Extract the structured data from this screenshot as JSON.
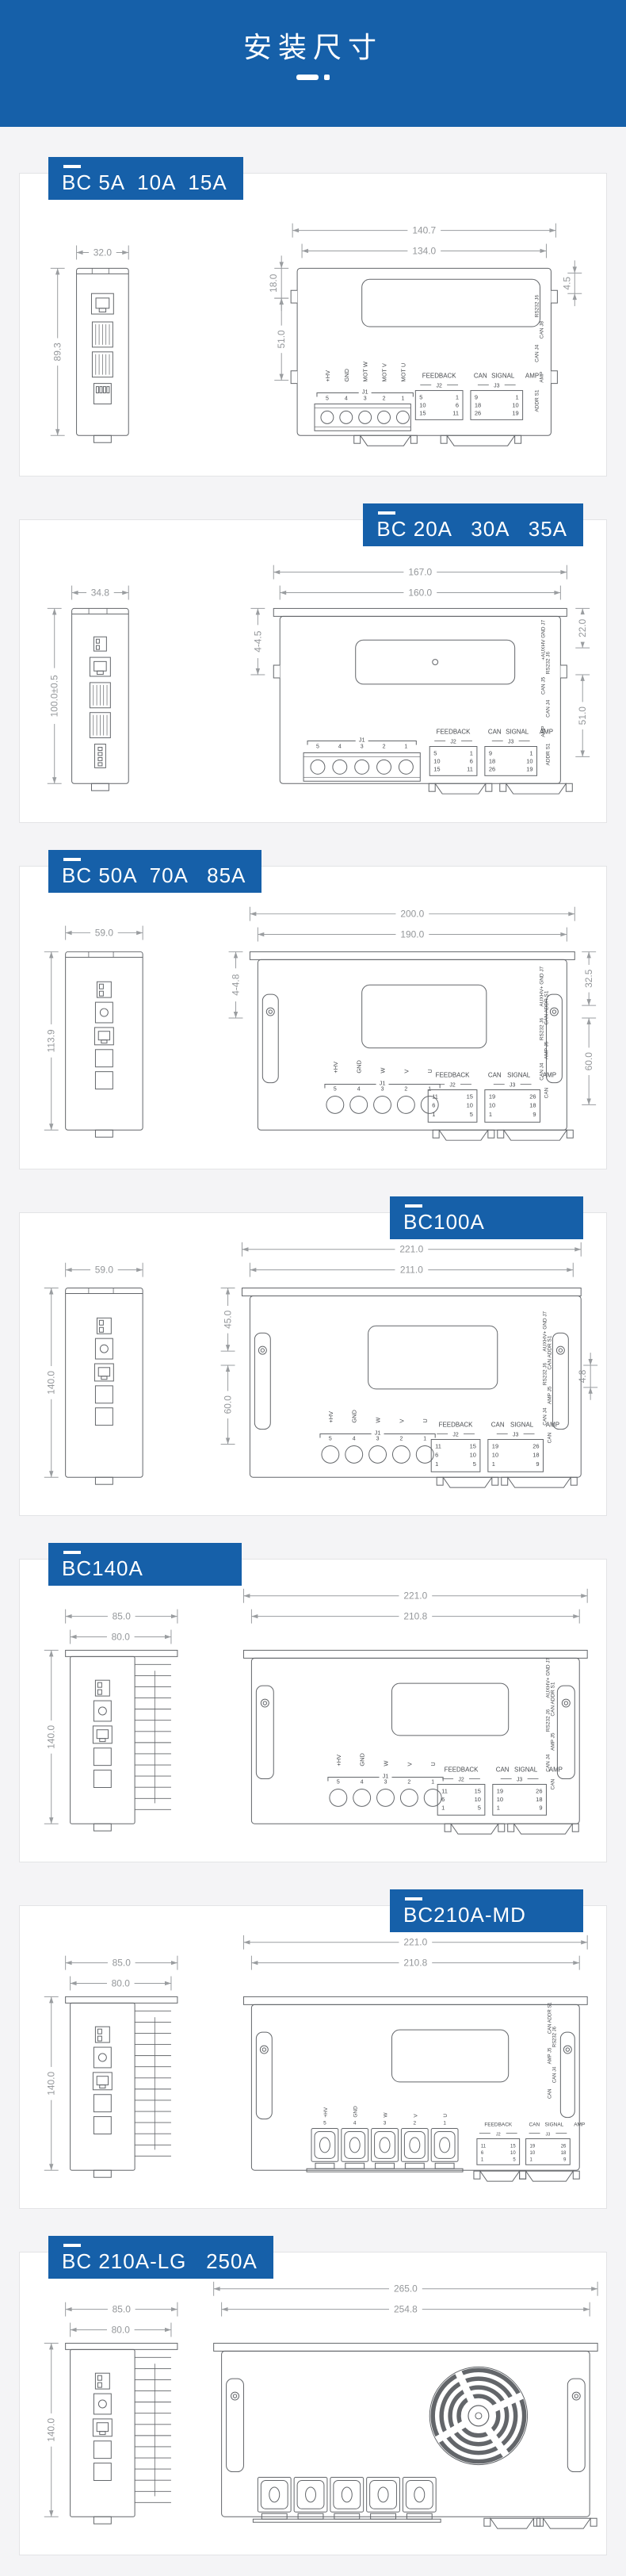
{
  "header": {
    "title": "安装尺寸"
  },
  "colors": {
    "accent": "#1660a9",
    "page_bg": "#f4f4f6",
    "card_bg": "#ffffff",
    "line": "#63666a",
    "dim_line": "#9a9da0"
  },
  "common": {
    "feedback": "FEEDBACK",
    "signal": "SIGNAL",
    "can": "CAN",
    "amp": "AMP",
    "j1": "J1",
    "j2": "J2",
    "j3": "J3"
  },
  "sections": [
    {
      "label": "BC 5A  10A  15A",
      "dims": {
        "side_w": "32.0",
        "side_h": "89.3",
        "front_w1": "140.7",
        "front_w2": "134.0",
        "left_a": "18.0",
        "left_b": "51.0",
        "right_a": "4.5"
      },
      "terminal_names": [
        "+HV",
        "GND",
        "MOT W",
        "MOT V",
        "MOT U"
      ],
      "terminal_pins": [
        "5",
        "4",
        "3",
        "2",
        "1"
      ],
      "feedback_pins_left": [
        "5",
        "10",
        "15"
      ],
      "feedback_pins_right": [
        "1",
        "6",
        "11"
      ],
      "signal_pins_left": [
        "9",
        "18",
        "26"
      ],
      "signal_pins_right": [
        "1",
        "10",
        "19"
      ],
      "right_labels": [
        "RS232 J6",
        "CAN J8",
        "CAN J4",
        "AMP",
        "ADDR S1"
      ]
    },
    {
      "label": "BC 20A   30A   35A",
      "dims": {
        "side_w": "34.8",
        "side_h": "100.0±0.5",
        "front_w1": "167.0",
        "front_w2": "160.0",
        "left_a": "4-4.5",
        "right_a": "22.0",
        "right_b": "51.0"
      },
      "terminal_names": [],
      "terminal_pins": [
        "5",
        "4",
        "3",
        "2",
        "1"
      ],
      "feedback_pins_left": [
        "5",
        "10",
        "15"
      ],
      "feedback_pins_right": [
        "1",
        "6",
        "11"
      ],
      "signal_pins_left": [
        "9",
        "18",
        "26"
      ],
      "signal_pins_right": [
        "1",
        "10",
        "19"
      ],
      "right_labels": [
        "+AUXHV GND J7",
        "RS232 J6",
        "CAN J5",
        "CAN J4",
        "AMP",
        "ADDR S1"
      ]
    },
    {
      "label": "BC 50A  70A   85A",
      "dims": {
        "side_w": "59.0",
        "side_h": "113.9",
        "front_w1": "200.0",
        "front_w2": "190.0",
        "left_a": "4-4.8",
        "right_a": "32.5",
        "right_b": "60.0"
      },
      "terminal_names": [
        "+HV",
        "GND",
        "W",
        "V",
        "U"
      ],
      "terminal_pins": [
        "5",
        "4",
        "3",
        "2",
        "1"
      ],
      "feedback_pins_left": [
        "11",
        "6",
        "1"
      ],
      "feedback_pins_right": [
        "15",
        "10",
        "5"
      ],
      "signal_pins_left": [
        "19",
        "10",
        "1"
      ],
      "signal_pins_right": [
        "26",
        "18",
        "9"
      ],
      "right_labels": [
        "AUXHV+ GND J7",
        "CAN ADDR S1",
        "RS232 J6",
        "AMP J5",
        "CAN J4",
        "CAN"
      ]
    },
    {
      "label": "BC100A",
      "dims": {
        "side_w": "59.0",
        "side_h": "140.0",
        "front_w1": "221.0",
        "front_w2": "211.0",
        "left_a": "45.0",
        "left_b": "60.0",
        "right_a": "4.8"
      },
      "terminal_names": [
        "+HV",
        "GND",
        "W",
        "V",
        "U"
      ],
      "terminal_pins": [
        "5",
        "4",
        "3",
        "2",
        "1"
      ],
      "feedback_pins_left": [
        "11",
        "6",
        "1"
      ],
      "feedback_pins_right": [
        "15",
        "10",
        "5"
      ],
      "signal_pins_left": [
        "19",
        "10",
        "1"
      ],
      "signal_pins_right": [
        "26",
        "18",
        "9"
      ],
      "right_labels": [
        "AUXHV+ GND J7",
        "CAN ADDR S1",
        "RS232 J6",
        "AMP J5",
        "CAN J4",
        "CAN"
      ]
    },
    {
      "label": "BC140A",
      "dims": {
        "side_w1": "85.0",
        "side_w2": "80.0",
        "side_h": "140.0",
        "front_w1": "221.0",
        "front_w2": "210.8"
      },
      "terminal_names": [
        "+HV",
        "GND",
        "W",
        "V",
        "U"
      ],
      "terminal_pins": [
        "5",
        "4",
        "3",
        "2",
        "1"
      ],
      "feedback_pins_left": [
        "11",
        "6",
        "1"
      ],
      "feedback_pins_right": [
        "15",
        "10",
        "5"
      ],
      "signal_pins_left": [
        "19",
        "10",
        "1"
      ],
      "signal_pins_right": [
        "26",
        "18",
        "9"
      ],
      "right_labels": [
        "AUXHV+ GND J7",
        "CAN ADDR S1",
        "RS232 J6",
        "AMP J5",
        "CAN J4",
        "CAN"
      ]
    },
    {
      "label": "BC210A-MD",
      "dims": {
        "side_w1": "85.0",
        "side_w2": "80.0",
        "side_h": "140.0",
        "front_w1": "221.0",
        "front_w2": "210.8"
      },
      "terminal_names": [
        "+HV",
        "GND",
        "W",
        "V",
        "U"
      ],
      "terminal_pins": [
        "5",
        "4",
        "3",
        "2",
        "1"
      ],
      "feedback_pins_left": [
        "11",
        "6",
        "1"
      ],
      "feedback_pins_right": [
        "15",
        "10",
        "5"
      ],
      "signal_pins_left": [
        "19",
        "10",
        "1"
      ],
      "signal_pins_right": [
        "26",
        "18",
        "9"
      ],
      "right_labels": [
        "CAN ADDR S1",
        "RS232 J6",
        "AMP J5",
        "CAN J4",
        "CAN"
      ]
    },
    {
      "label": "BC 210A-LG   250A",
      "dims": {
        "side_w1": "85.0",
        "side_w2": "80.0",
        "side_h": "140.0",
        "front_w1": "265.0",
        "front_w2": "254.8"
      },
      "terminal_names": [],
      "terminal_pins": [],
      "right_labels": []
    }
  ]
}
